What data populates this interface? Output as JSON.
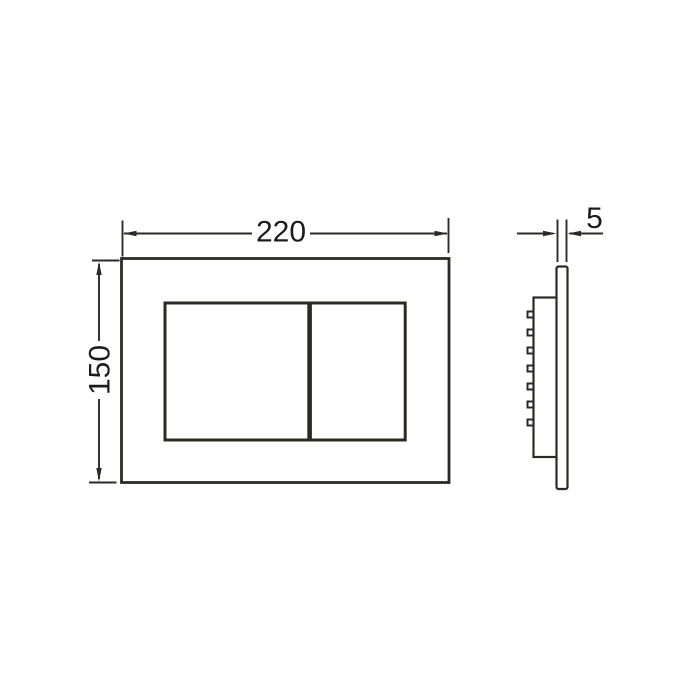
{
  "drawing": {
    "type": "technical-dimension-drawing",
    "subject": "dual-flush actuator plate",
    "front_view": {
      "width_dimension": "220",
      "height_dimension": "150"
    },
    "side_view": {
      "thickness_dimension": "5",
      "clip_count": 7
    },
    "colors": {
      "line": "#2b2b26",
      "text": "#1c1c1c",
      "background": "#ffffff"
    }
  }
}
